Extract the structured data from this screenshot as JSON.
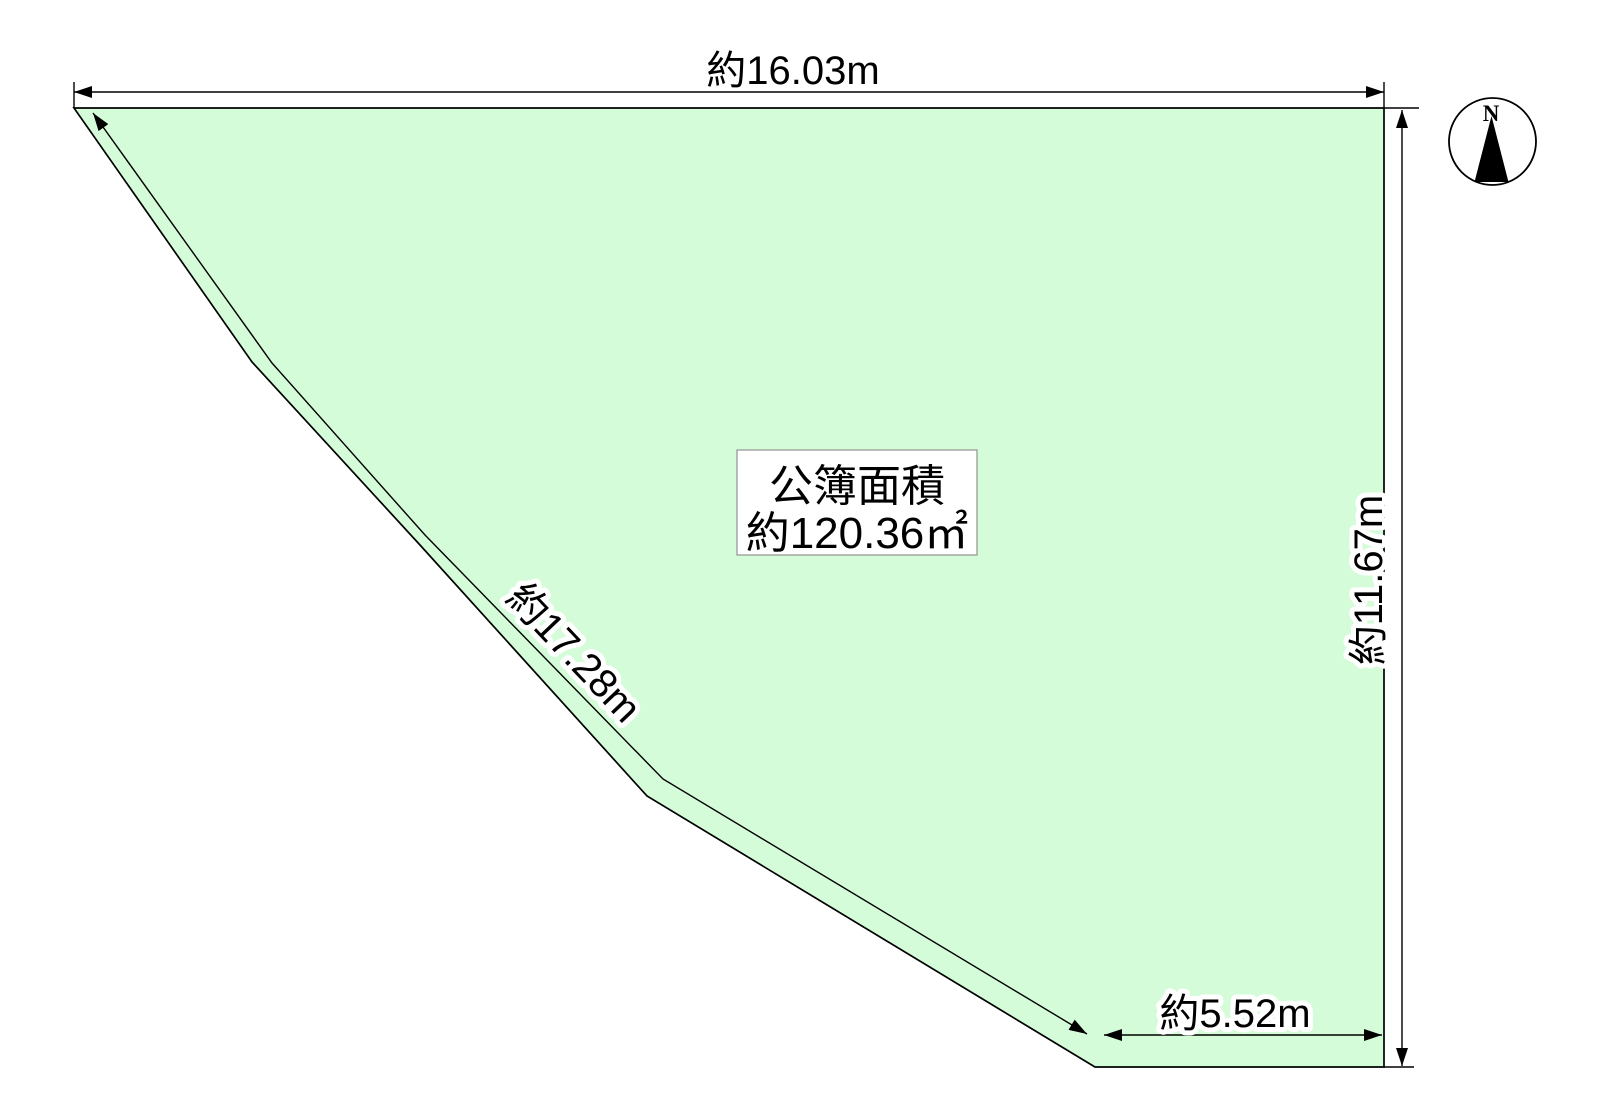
{
  "diagram": {
    "dimensions": {
      "top": "約16.03m",
      "right": "約11.67m",
      "left": "約17.28m",
      "bottom": "約5.52m"
    },
    "area_box": {
      "title": "公簿面積",
      "value": "約120.36㎡"
    },
    "compass": {
      "label": "N"
    },
    "colors": {
      "plot_fill": "#d5fcd8",
      "outline": "#000000",
      "box_fill": "#ffffff",
      "box_border": "#919191"
    }
  }
}
